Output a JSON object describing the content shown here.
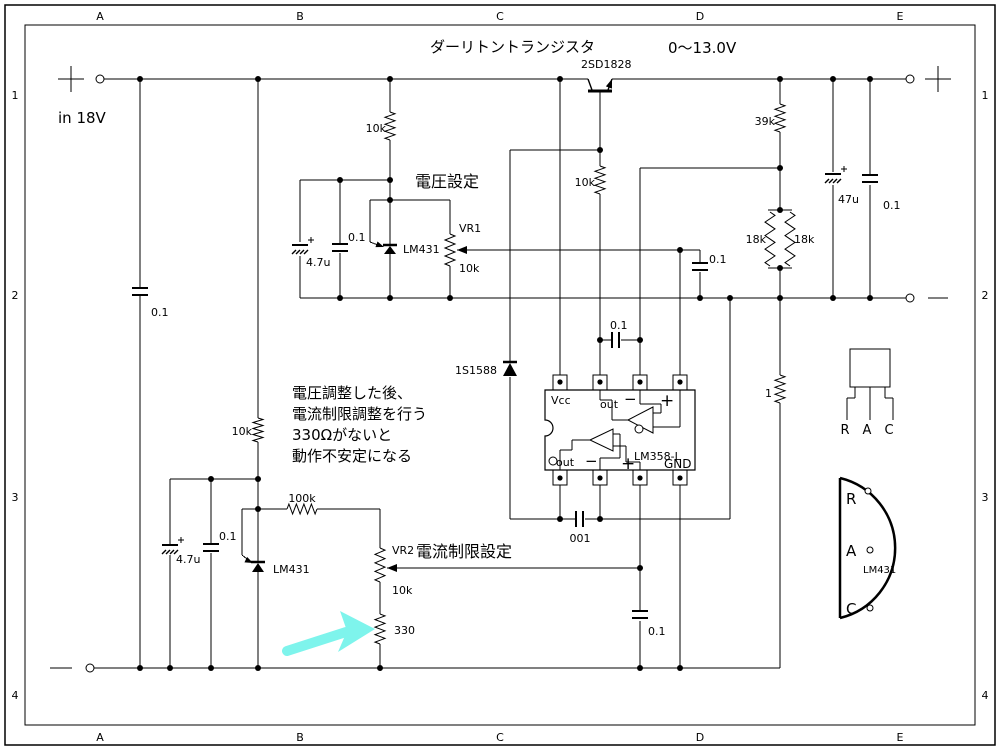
{
  "sheet": {
    "background": "#ffffff",
    "ink": "#000000",
    "highlight_arrow_color": "#7EF4EC",
    "grid_columns": [
      "A",
      "B",
      "C",
      "D",
      "E"
    ],
    "grid_rows": [
      "1",
      "2",
      "3",
      "4"
    ]
  },
  "labels": [
    {
      "id": "input_voltage",
      "text": "in 18V"
    },
    {
      "id": "title",
      "text": "ダーリトントランジスタ"
    },
    {
      "id": "output_range",
      "text": "0〜13.0V"
    },
    {
      "id": "q1",
      "text": "2SD1828"
    },
    {
      "id": "r_vset_10k",
      "text": "10k"
    },
    {
      "id": "heading_vset",
      "text": "電圧設定"
    },
    {
      "id": "r_39k",
      "text": "39k"
    },
    {
      "id": "c_in_01",
      "text": "0.1"
    },
    {
      "id": "c_vset_47u",
      "text": "4.7u"
    },
    {
      "id": "c_vset_01",
      "text": "0.1"
    },
    {
      "id": "u_vset_lm431",
      "text": "LM431"
    },
    {
      "id": "vr1",
      "text": "VR1"
    },
    {
      "id": "vr1_val",
      "text": "10k"
    },
    {
      "id": "r_18k_l",
      "text": "18k"
    },
    {
      "id": "r_18k_r",
      "text": "18k"
    },
    {
      "id": "c_out_47u",
      "text": "47u"
    },
    {
      "id": "c_out_01",
      "text": "0.1"
    },
    {
      "id": "r_base_10k",
      "text": "10k"
    },
    {
      "id": "c_fb_01",
      "text": "0.1"
    },
    {
      "id": "c_comp_01",
      "text": "0.1"
    },
    {
      "id": "d_1s1588",
      "text": "1S1588"
    },
    {
      "id": "note_1",
      "text": "電圧調整した後、"
    },
    {
      "id": "note_2",
      "text": "電流制限調整を行う"
    },
    {
      "id": "note_3",
      "text": "330Ωがないと"
    },
    {
      "id": "note_4",
      "text": "動作不安定になる"
    },
    {
      "id": "r_ilim_10k",
      "text": "10k"
    },
    {
      "id": "r_100k",
      "text": "100k"
    },
    {
      "id": "c_ilim_47u",
      "text": "4.7u"
    },
    {
      "id": "c_ilim_01",
      "text": "0.1"
    },
    {
      "id": "u_ilim_lm431",
      "text": "LM431"
    },
    {
      "id": "heading_ilim",
      "text": "電流制限設定"
    },
    {
      "id": "vr2",
      "text": "VR2"
    },
    {
      "id": "vr2_val",
      "text": "10k"
    },
    {
      "id": "r_330",
      "text": "330"
    },
    {
      "id": "c_001",
      "text": "001"
    },
    {
      "id": "c_ref_01",
      "text": "0.1"
    },
    {
      "id": "r_1",
      "text": "1"
    },
    {
      "id": "ic_vcc",
      "text": "Vcc"
    },
    {
      "id": "ic_out_top",
      "text": "out"
    },
    {
      "id": "ic_minus_top",
      "text": "−"
    },
    {
      "id": "ic_plus_top",
      "text": "+"
    },
    {
      "id": "ic_out_bot",
      "text": "out"
    },
    {
      "id": "ic_minus_bot",
      "text": "−"
    },
    {
      "id": "ic_plus_bot",
      "text": "+"
    },
    {
      "id": "ic_part",
      "text": "LM358-L"
    },
    {
      "id": "ic_gnd",
      "text": "GND"
    },
    {
      "id": "pkg_r",
      "text": "R"
    },
    {
      "id": "pkg_a",
      "text": "A"
    },
    {
      "id": "pkg_c",
      "text": "C"
    },
    {
      "id": "dpkg_r",
      "text": "R"
    },
    {
      "id": "dpkg_a",
      "text": "A"
    },
    {
      "id": "dpkg_c",
      "text": "C"
    },
    {
      "id": "dpkg_part",
      "text": "LM431"
    }
  ]
}
